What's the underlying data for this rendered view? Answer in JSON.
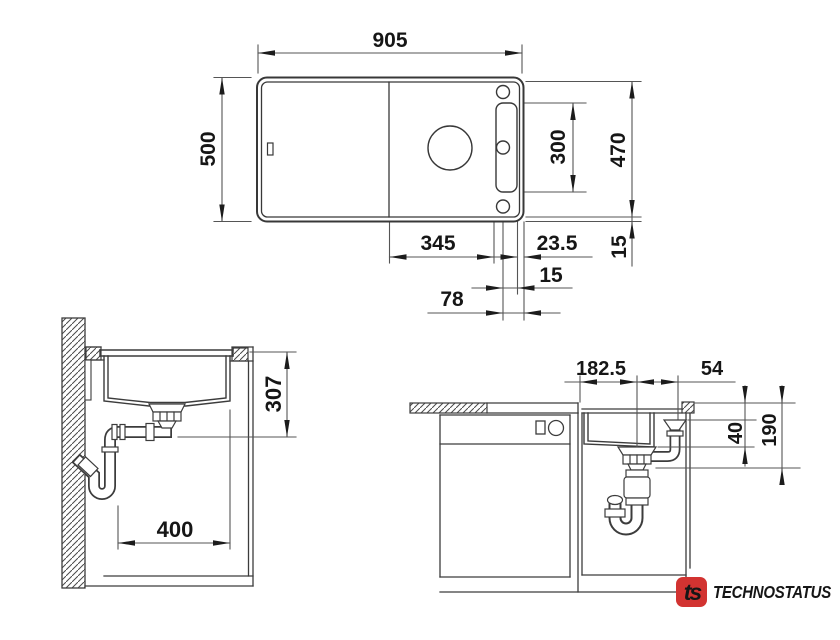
{
  "title": "Sink installation dimension drawing",
  "views": {
    "top": {
      "dims": {
        "overall_width": "905",
        "overall_depth": "500",
        "inner_depth": "470",
        "tap_panel_height": "300",
        "bowl_to_tap": "345",
        "tap_edge_offset": "23.5",
        "tap_gap": "15",
        "rim_width": "15",
        "tap_center_offset": "78"
      }
    },
    "side_section": {
      "dims": {
        "drain_height": "307",
        "cabinet_width": "400"
      }
    },
    "front_section": {
      "dims": {
        "drain_offset": "182.5",
        "overflow_offset": "54",
        "ledge_depth": "40",
        "bowl_depth": "190"
      }
    }
  },
  "logo": {
    "monogram": "ts",
    "brand": "TECHNOSTATUS",
    "badge_color": "#d23331",
    "text_color": "#223a63"
  },
  "colors": {
    "line": "#3c3c3c",
    "dim_line": "#555555",
    "text": "#161616",
    "background": "#ffffff"
  }
}
